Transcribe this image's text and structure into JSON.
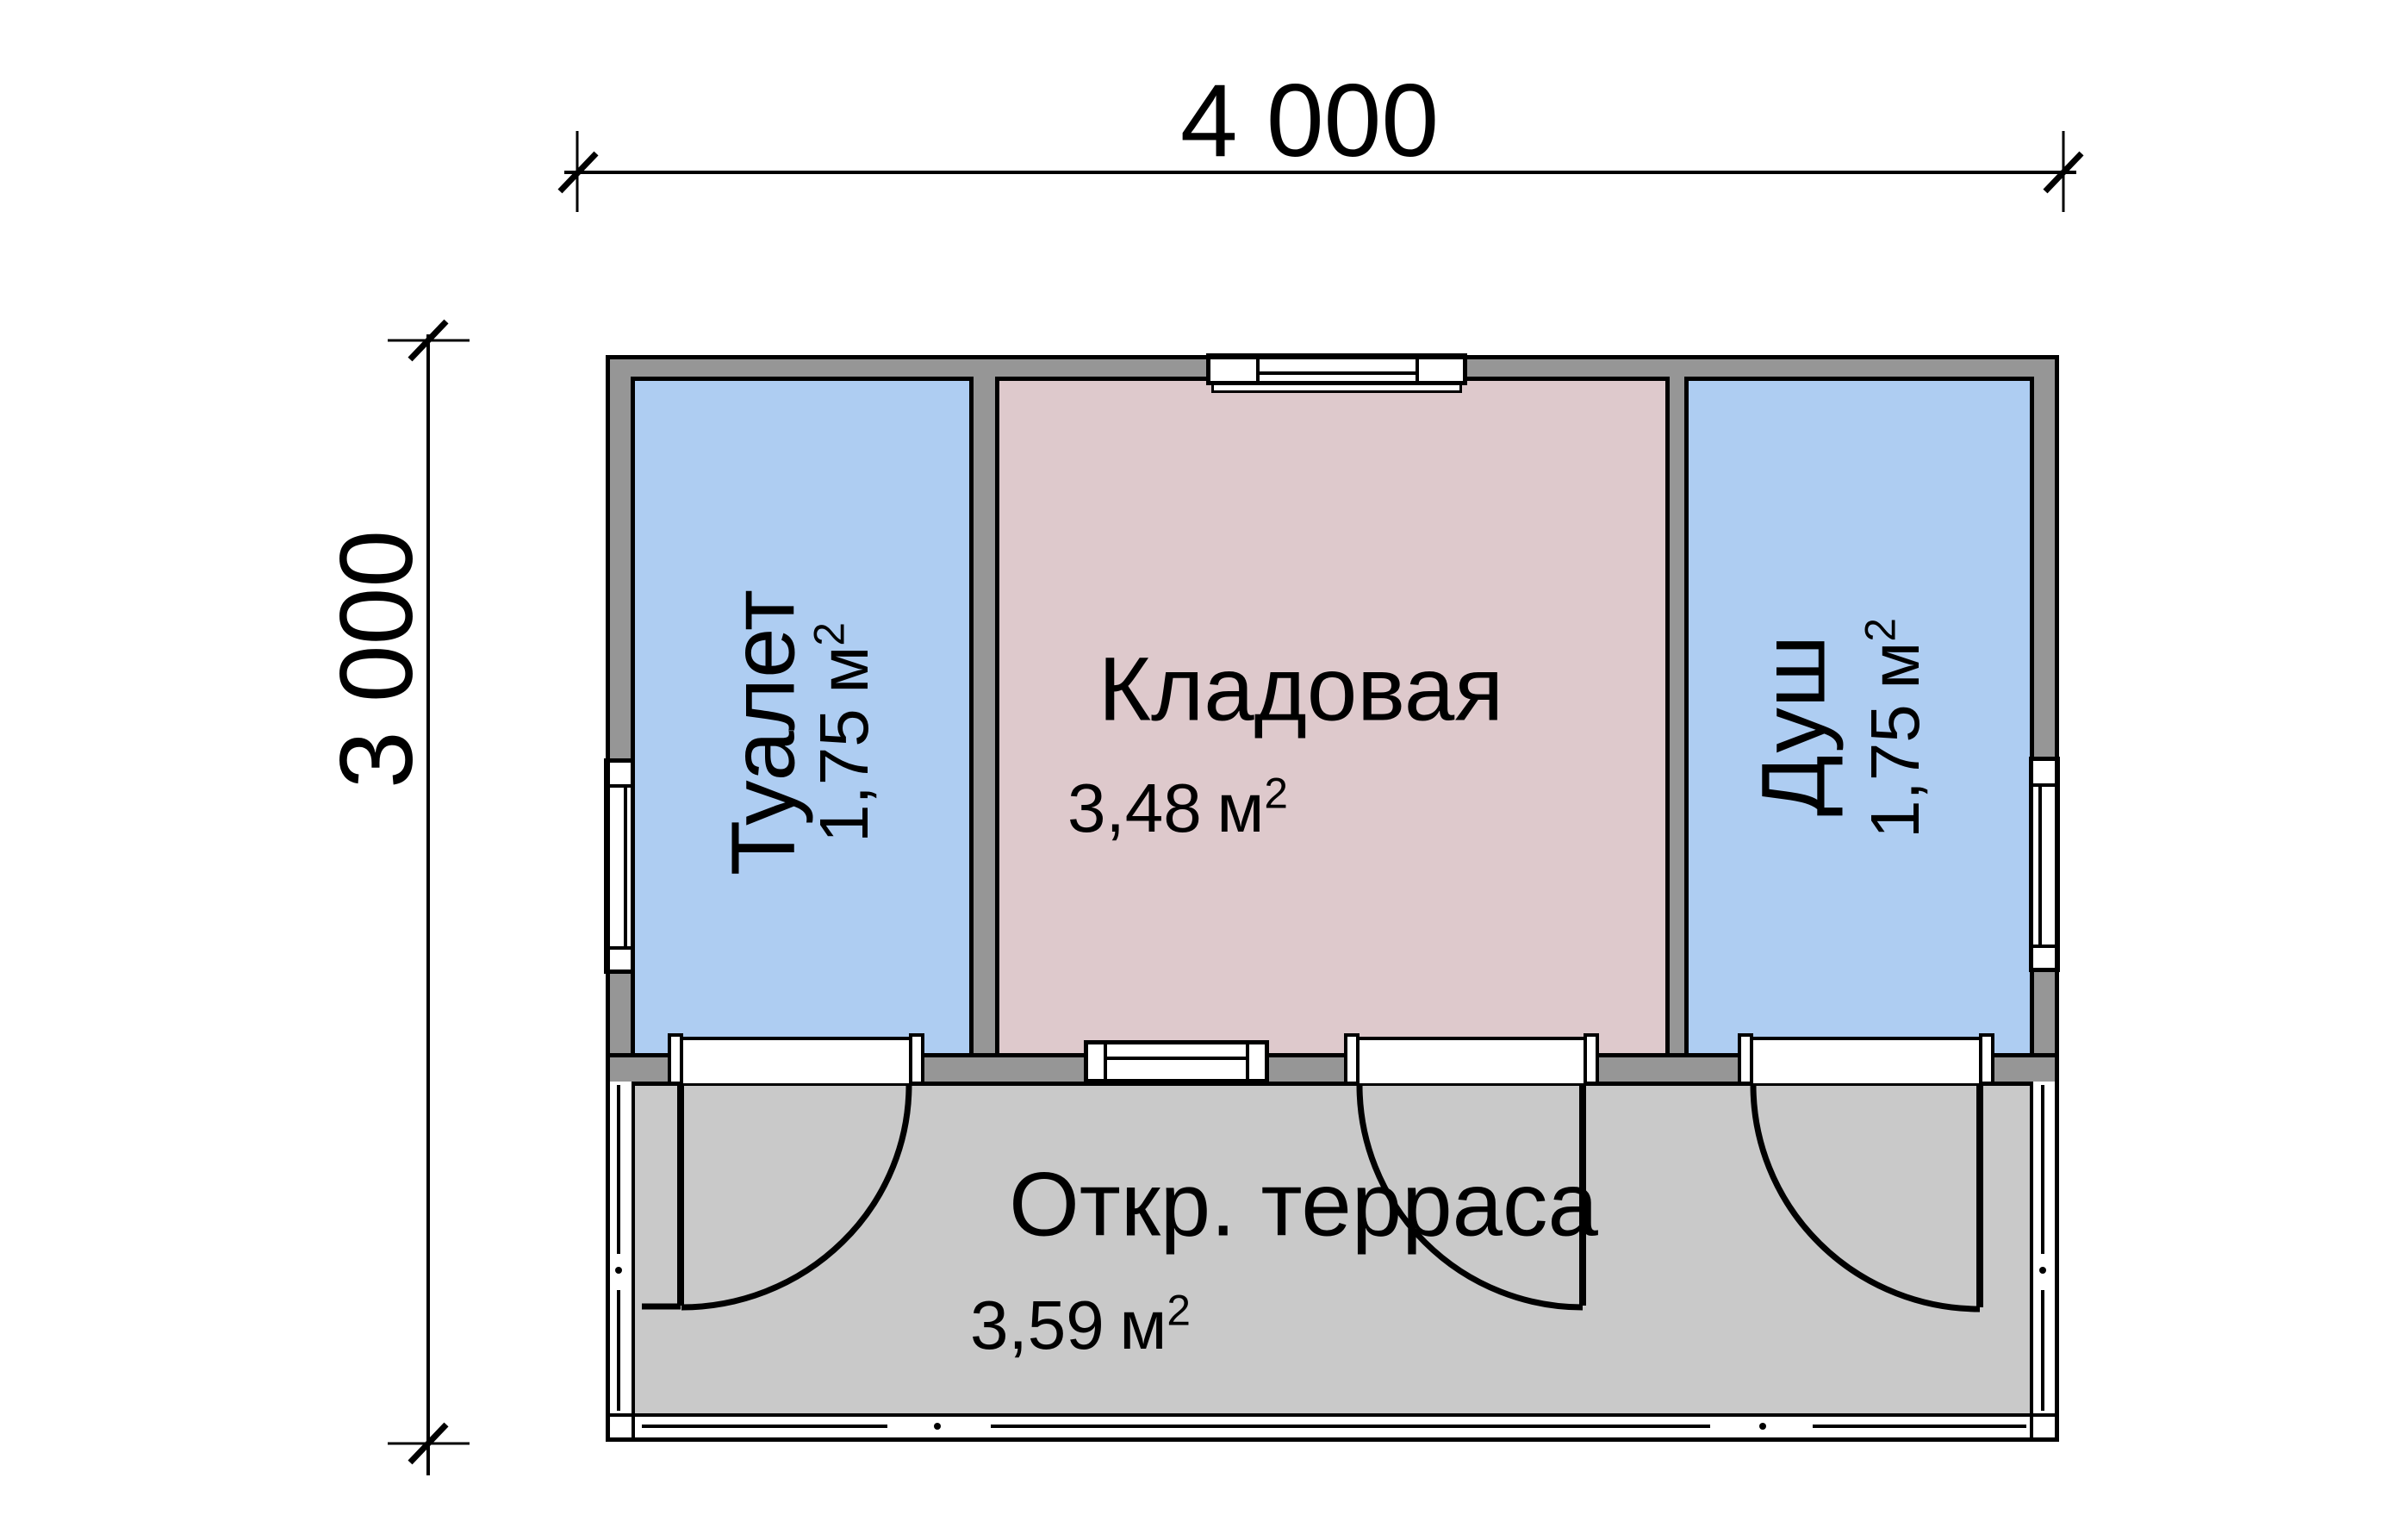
{
  "dimensions": {
    "width": "4 000",
    "height": "3 000"
  },
  "rooms": {
    "toilet": {
      "name": "Туалет",
      "area_value": "1,75",
      "area_unit": "м",
      "area_sup": "2"
    },
    "storage": {
      "name": "Кладовая",
      "area_value": "3,48",
      "area_unit": "м",
      "area_sup": "2"
    },
    "shower": {
      "name": "Душ",
      "area_value": "1,75",
      "area_unit": "м",
      "area_sup": "2"
    },
    "terrace": {
      "name": "Откр. терраса",
      "area_value": "3,59",
      "area_unit": "м",
      "area_sup": "2"
    }
  },
  "colors": {
    "wall_gray": "#969696",
    "room_blue": "#aecdf2",
    "room_pink": "#dec9cc",
    "terrace_gray": "#c9c9c9",
    "window_white": "#ffffff",
    "line_black": "#000000"
  }
}
